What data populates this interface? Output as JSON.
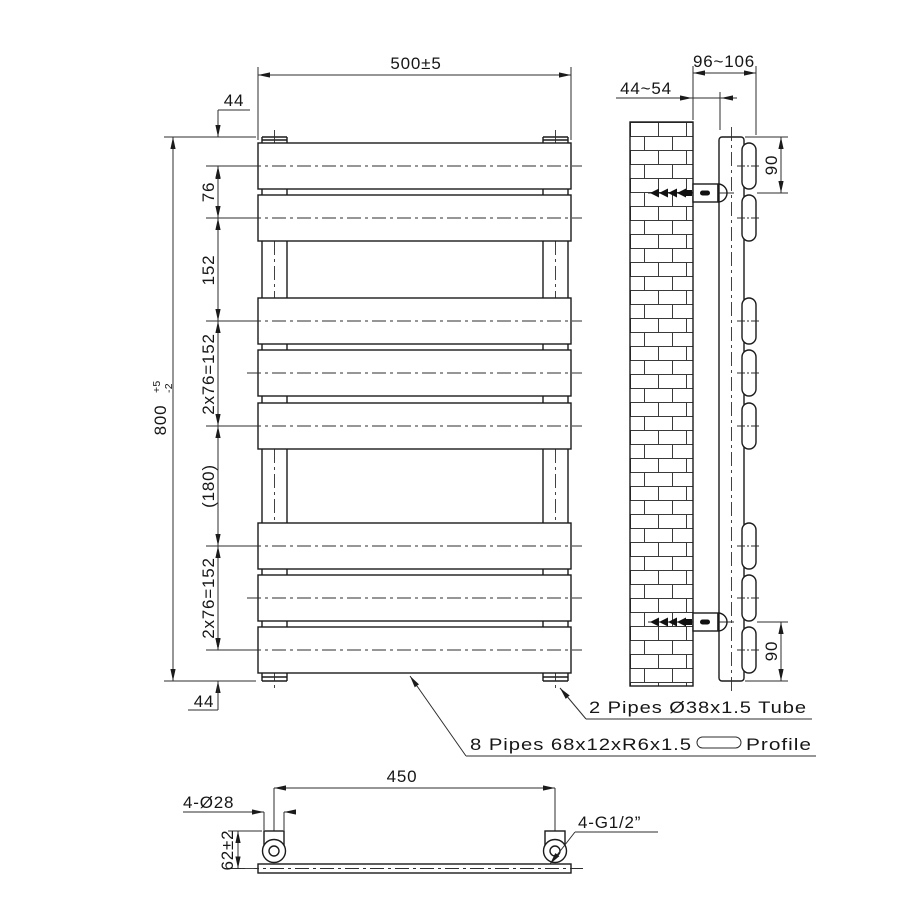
{
  "front_view": {
    "width": "500±5",
    "height": "800",
    "height_tol_up": "+5",
    "height_tol_down": "-2",
    "top_offset": "44",
    "rail_pitch_76": "76",
    "rail_pitch_152": "152",
    "rail_pitch_2x76_upper": "2x76=152",
    "centre_gap_180": "(180)",
    "rail_pitch_2x76_lower": "2x76=152",
    "bottom_offset": "44"
  },
  "side_view": {
    "wall_clearance": "44~54",
    "total_depth": "96~106",
    "bracket_from_top": "90",
    "bracket_from_bottom": "90"
  },
  "bottom_view": {
    "connection_centres": "450",
    "holes": "4-Ø28",
    "connection_height": "62±2",
    "thread": "4-G1/2”"
  },
  "notes": {
    "tube_spec": "2 Pipes Ø38x1.5 Tube",
    "profile_spec": "8 Pipes 68x12xR6x1.5",
    "profile_suffix": "Profile"
  }
}
